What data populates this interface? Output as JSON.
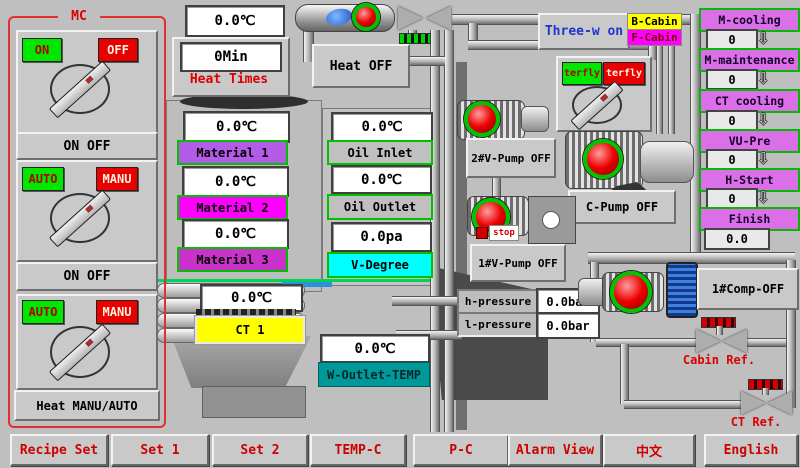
{
  "colors": {
    "background": "#bfbfbf",
    "panel": "#c9c9c9",
    "green_button": "#00e800",
    "red_button": "#e80000",
    "magenta": "#ff00ff",
    "violet_stage": "#db6fe8",
    "cyan": "#00ffff",
    "yellow": "#ffff00",
    "teal": "#009898",
    "mc_border_red": "#e03030",
    "nav_text_red": "#cc0000",
    "indicator_red": "#ee0000",
    "indicator_ring_green": "#00c400",
    "material1": "#b45ce8",
    "material3": "#cb32cb"
  },
  "icons": {
    "down_arrow": "⇩"
  },
  "mc": {
    "title": "MC",
    "groups": [
      {
        "btn_left": "ON",
        "btn_right": "OFF",
        "label": "ON OFF"
      },
      {
        "btn_left": "AUTO",
        "btn_right": "MANU",
        "label": "ON OFF"
      },
      {
        "btn_left": "AUTO",
        "btn_right": "MANU",
        "label": "Heat MANU/AUTO"
      }
    ]
  },
  "heater": {
    "temp": "0.0℃",
    "heat_times_value": "0Min",
    "heat_times_label": "Heat Times",
    "heat_status": "Heat OFF"
  },
  "top_right": {
    "three_way": "Three-w on",
    "b_cabin": "B-Cabin",
    "f_cabin": "F-Cabin",
    "butterfly_on": "terfly",
    "butterfly_off": "terfly"
  },
  "stages": [
    {
      "label": "M-cooling",
      "value": "0"
    },
    {
      "label": "M-maintenance",
      "value": "0"
    },
    {
      "label": "CT cooling",
      "value": "0"
    },
    {
      "label": "VU-Pre",
      "value": "0"
    },
    {
      "label": "H-Start",
      "value": "0"
    },
    {
      "label": "Finish",
      "value": "0.0"
    }
  ],
  "materials": [
    {
      "label": "Material 1",
      "value": "0.0℃"
    },
    {
      "label": "Material 2",
      "value": "0.0℃"
    },
    {
      "label": "Material 3",
      "value": "0.0℃"
    }
  ],
  "oil": [
    {
      "label": "Oil Inlet",
      "value": "0.0℃"
    },
    {
      "label": "Oil Outlet",
      "value": "0.0℃"
    },
    {
      "label": "V-Degree",
      "value": "0.0pa"
    }
  ],
  "ct1": {
    "label": "CT 1",
    "value": "0.0℃"
  },
  "w_outlet": {
    "label": "W-Outlet-TEMP",
    "value": "0.0℃"
  },
  "pressures": {
    "h_label": "h-pressure",
    "h_value": "0.0bar",
    "l_label": "l-pressure",
    "l_value": "0.0bar"
  },
  "equipment": {
    "vpump2": "2#V-Pump OFF",
    "vpump1": "1#V-Pump OFF",
    "vpump1_stop": "stop",
    "cpump": "C-Pump OFF",
    "comp1": "1#Comp-OFF",
    "cabin_ref": "Cabin Ref.",
    "ct_ref": "CT Ref."
  },
  "nav": [
    {
      "label": "Recipe Set"
    },
    {
      "label": "Set 1"
    },
    {
      "label": "Set 2"
    },
    {
      "label": "TEMP-C"
    },
    {
      "label": "P-C"
    },
    {
      "label": "Alarm View"
    },
    {
      "label": "中文"
    },
    {
      "label": "English"
    }
  ]
}
